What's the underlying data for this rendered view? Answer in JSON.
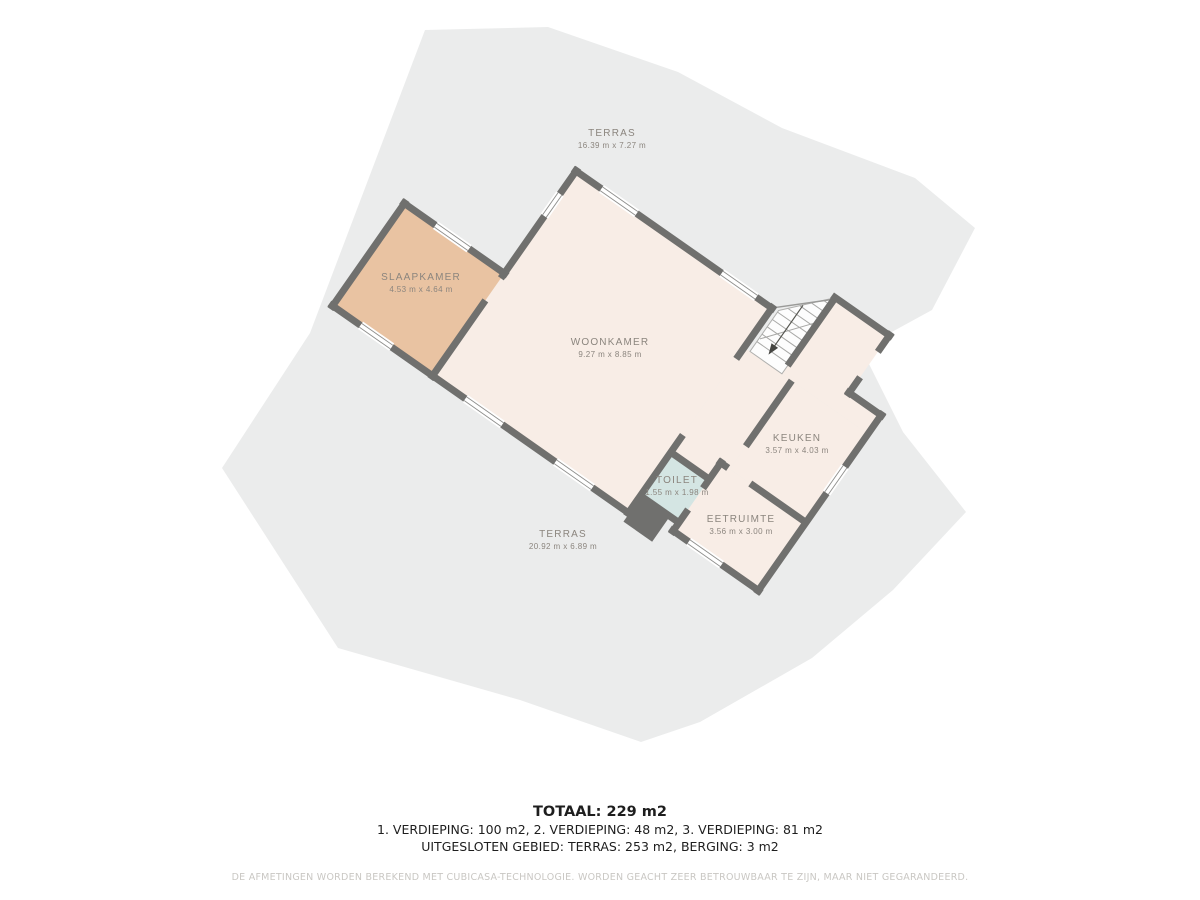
{
  "floorplan": {
    "rooms": {
      "terras_top": {
        "name": "TERRAS",
        "dims": "16.39 m x 7.27 m"
      },
      "slaapkamer": {
        "name": "SLAAPKAMER",
        "dims": "4.53 m x 4.64 m"
      },
      "woonkamer": {
        "name": "WOONKAMER",
        "dims": "9.27 m x 8.85 m"
      },
      "keuken": {
        "name": "KEUKEN",
        "dims": "3.57 m x 4.03 m"
      },
      "toilet": {
        "name": "TOILET",
        "dims": "1.55 m x 1.98 m"
      },
      "eetruimte": {
        "name": "EETRUIMTE",
        "dims": "3.56 m x 3.00 m"
      },
      "terras_bottom": {
        "name": "TERRAS",
        "dims": "20.92 m x 6.89 m"
      }
    },
    "colors": {
      "wall": "#70706e",
      "floor": "#f8ede6",
      "bedroom_floor": "#e9c3a2",
      "toilet_floor": "#d4e5e3",
      "terrace": "#ebecec",
      "stair_lines": "#a8a8a6",
      "label_text": "#8b857e"
    },
    "summary": {
      "total": "TOTAAL: 229 m2",
      "floors": "1. VERDIEPING: 100 m2, 2. VERDIEPING: 48 m2, 3. VERDIEPING: 81 m2",
      "excluded": "UITGESLOTEN GEBIED: TERRAS: 253 m2, BERGING: 3 m2"
    },
    "disclaimer": "DE AFMETINGEN WORDEN BEREKEND MET CUBICASA-TECHNOLOGIE. WORDEN GEACHT ZEER BETROUWBAAR TE ZIJN, MAAR NIET GEGARANDEERD."
  }
}
